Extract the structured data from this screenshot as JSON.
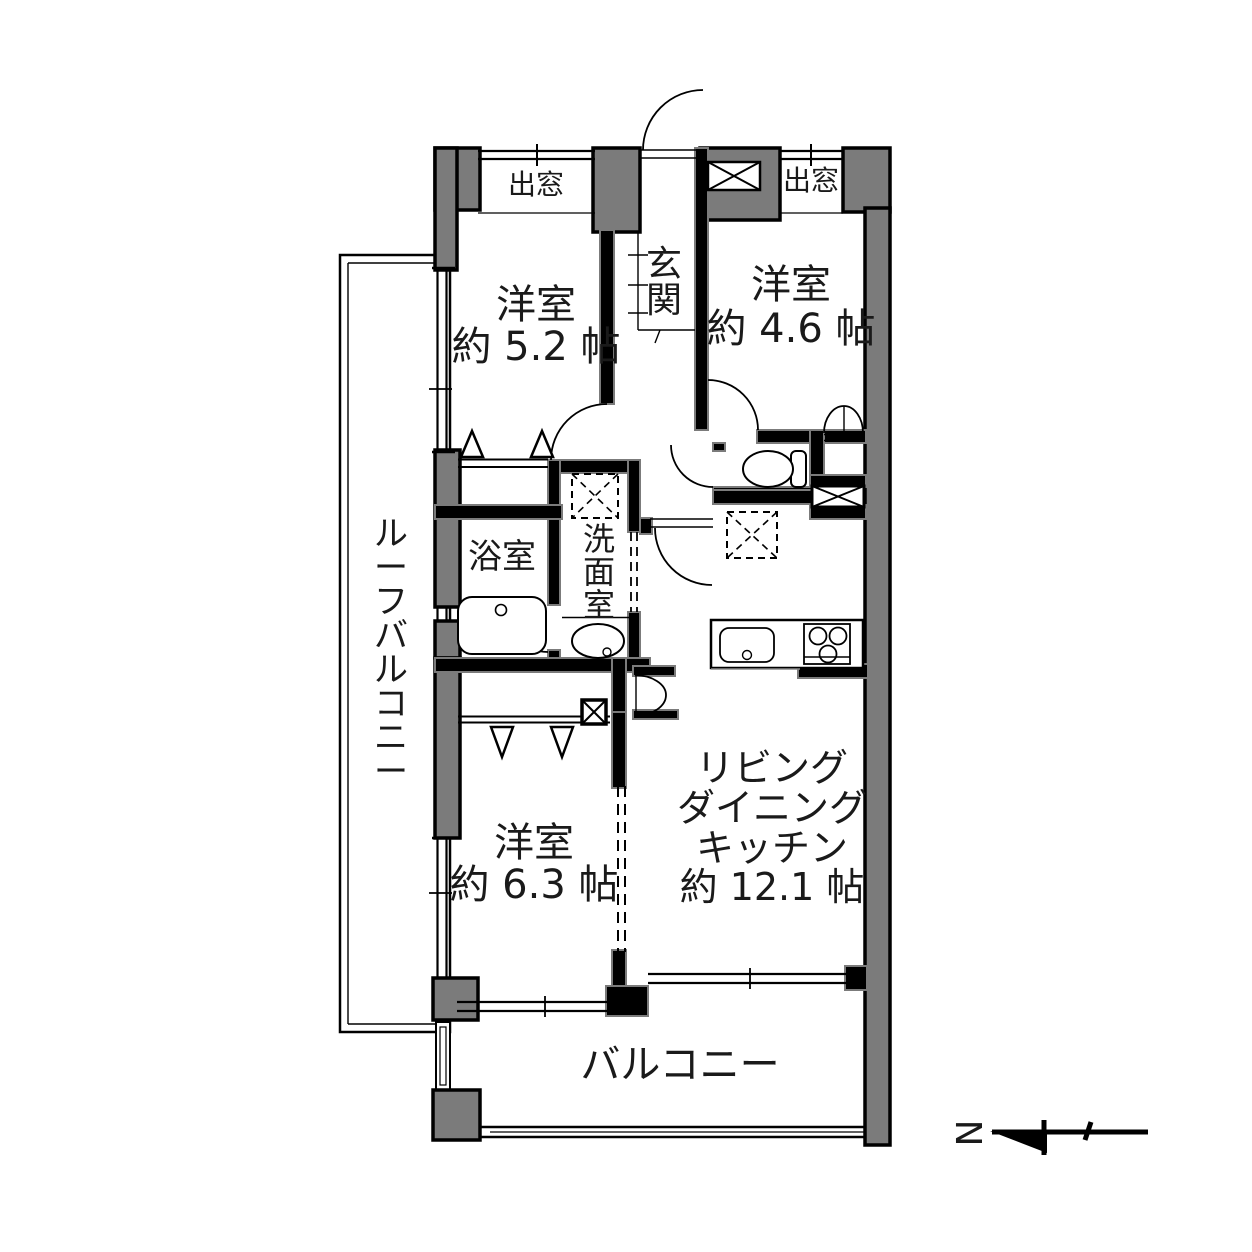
{
  "plan": {
    "rooms": {
      "bedroom1": {
        "label": "洋室",
        "area": "約 5.2 帖"
      },
      "bedroom2": {
        "label": "洋室",
        "area": "約 4.6 帖"
      },
      "bedroom3": {
        "label": "洋室",
        "area": "約 6.3 帖"
      },
      "ldk": {
        "line1": "リビング",
        "line2": "ダイニング",
        "line3": "キッチン",
        "area": "約 12.1 帖"
      },
      "entrance": "玄関",
      "bathroom": "浴室",
      "washroom": "洗面室",
      "balcony": "バルコニー",
      "roof_balcony": "ルーフバルコニー",
      "bay_window_left": "出窓",
      "bay_window_right": "出窓"
    },
    "compass": {
      "north": "N"
    },
    "colors": {
      "wall_fill": "#7b7b7b",
      "line": "#000000",
      "background": "#ffffff"
    }
  }
}
